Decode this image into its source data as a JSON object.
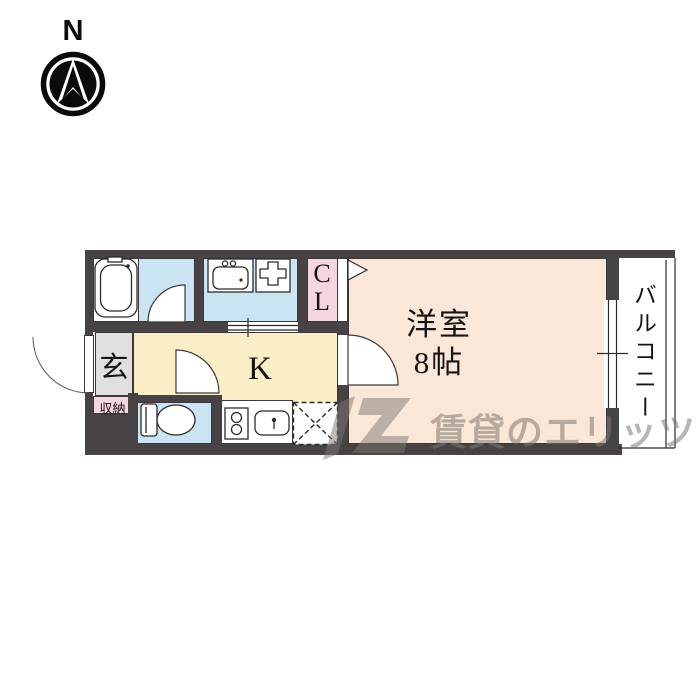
{
  "compass": {
    "north_label": "N"
  },
  "floorplan": {
    "western_room": {
      "name": "洋室",
      "size": "8帖"
    },
    "kitchen_label": "K",
    "closet_label": "CL",
    "balcony_label": "バルコニー",
    "entrance_label": "玄",
    "storage_label": "収納",
    "fixtures": [
      "bathtub",
      "washbasin",
      "washing-machine-pan",
      "toilet",
      "two-burner-stove",
      "kitchen-sink",
      "refrigerator-space"
    ],
    "colors": {
      "wall": "#474243",
      "water_blue": "#cbe4f4",
      "kitchen_yellow": "#f9eec6",
      "room_peach": "#fbe7d8",
      "closet_pink": "#f4d5e1",
      "entrance_gray": "#e0dfe1"
    }
  },
  "watermark": {
    "text": "賃貸のエリッツ"
  }
}
